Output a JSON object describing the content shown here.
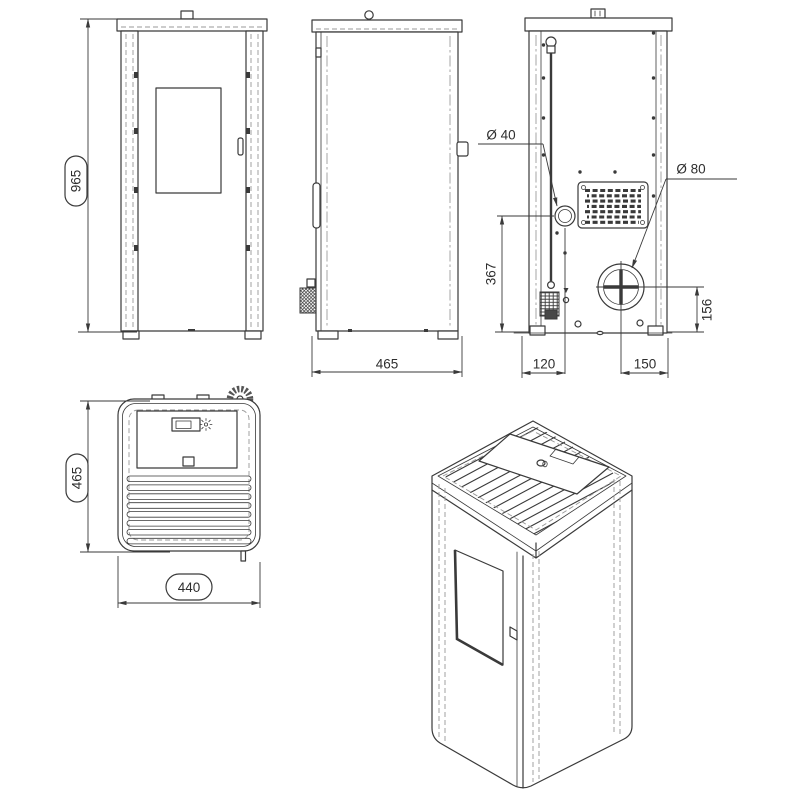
{
  "colors": {
    "line": "#3a3a3a",
    "hidden_line": "#989898",
    "background": "#ffffff"
  },
  "dims": {
    "front": {
      "height": "965"
    },
    "side": {
      "depth": "465"
    },
    "rear": {
      "intake_dia": "Ø 40",
      "flue_dia": "Ø 80",
      "intake_height": "367",
      "flue_height": "156",
      "intake_offset": "120",
      "flue_offset": "150"
    },
    "top": {
      "depth": "465",
      "width": "440"
    }
  }
}
